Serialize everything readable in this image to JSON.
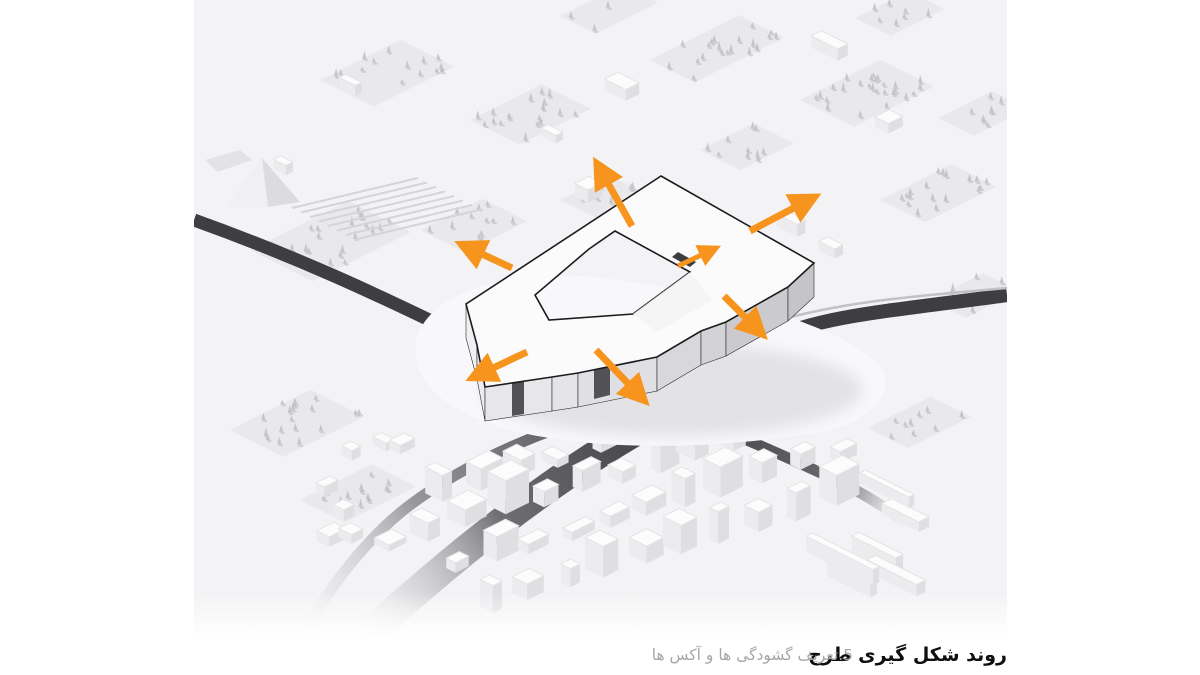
{
  "page": {
    "background": "#ffffff"
  },
  "figure": {
    "type": "architectural-massing-axonometric-diagram",
    "caption": {
      "title": "روند شکل گیری طرح",
      "step": "5.تعریف گشودگی ها و آکس ها",
      "step_number": "5"
    },
    "arrows": {
      "color": "#F7941D",
      "count": 7,
      "directions": [
        "northwest",
        "northeast",
        "west",
        "southwest",
        "south-through-notch",
        "southeast",
        "courtyard-gap-northeast"
      ]
    },
    "colors": {
      "ground": "#f3f3f5",
      "block": "#e9e9ec",
      "tree": "#c6c6ca",
      "tree_shadow": "#b9b9bd",
      "road": "#3e3e41",
      "road_light": "#c2c2c6",
      "building_top": "#fbfbfc",
      "building_outline": "#1b1b1d",
      "courtyard": "#46464a",
      "plaza": "#f8f8fa",
      "box_top": "#fcfcfd",
      "box_left": "#ececef",
      "box_right": "#dfdfe2",
      "caption_title": "#0f0f10",
      "caption_step": "#a6a6a9"
    }
  }
}
